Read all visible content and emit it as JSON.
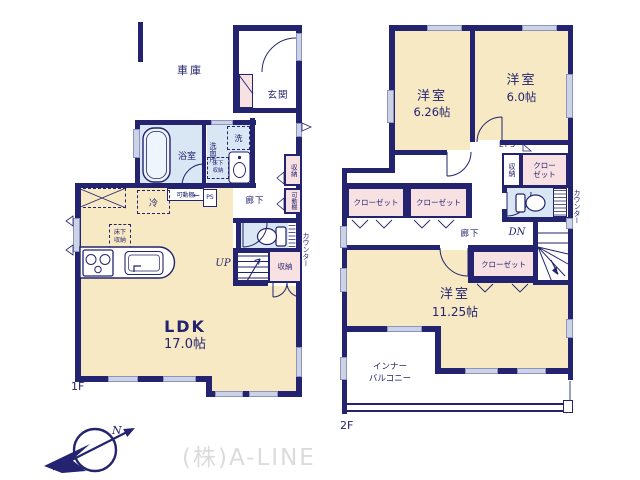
{
  "watermark": "(株)A-LINE",
  "compass": {
    "n": "N"
  },
  "colors": {
    "wall": "#23236f",
    "room_cream": "#f7e9c3",
    "wet_blue": "#d9e7f5",
    "closet_pink": "#f8e1e3",
    "window_gray": "#cdd3e6",
    "watermark_gray": "#dbdbdb"
  },
  "floor1": {
    "label": "1F",
    "garage": "車庫",
    "entrance": "玄関",
    "bath": "浴室",
    "washroom": "洗面所",
    "washer": "洗",
    "underfloor_storage": "床下収納",
    "underfloor_storage_kitchen": "床下収納",
    "movable_shelf": "可動棚",
    "movable_shelf_side": "可動棚",
    "ps": "PS",
    "ps_arrow": "←",
    "fridge": "冷",
    "corridor": "廊下",
    "storage_side": "収納",
    "counter": "カウンター",
    "up": "UP",
    "stair_storage": "収納",
    "ldk": "LDK",
    "ldk_size": "17.0帖"
  },
  "floor2": {
    "label": "2F",
    "room1": "洋室",
    "room1_size": "6.26帖",
    "room2": "洋室",
    "room2_size": "6.0帖",
    "room3": "洋室",
    "room3_size": "11.25帖",
    "eps": "EPS",
    "storage": "収納",
    "closet_top_right": "クローゼット",
    "counter": "カウンター",
    "closet_left_1": "クローゼット",
    "closet_left_2": "クローゼット",
    "closet_middle": "クローゼット",
    "corridor": "廊下",
    "dn": "DN",
    "inner_balcony_1": "インナー",
    "inner_balcony_2": "バルコニー"
  }
}
